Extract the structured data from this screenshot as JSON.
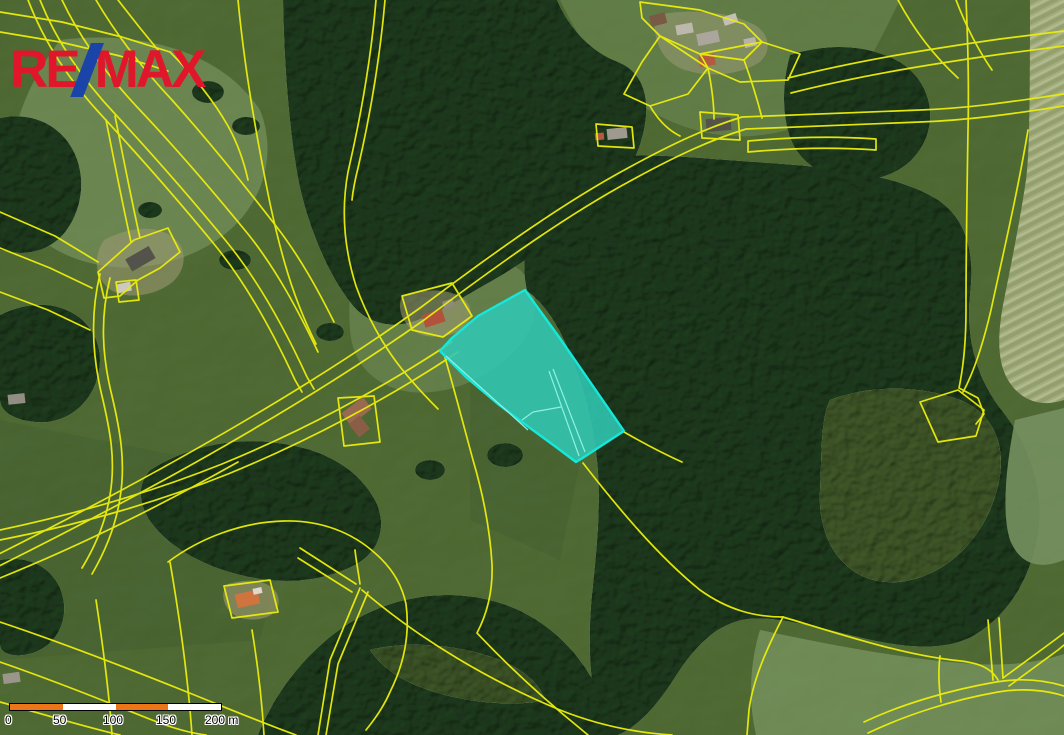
{
  "page": {
    "title": "Aerial cadastral map with highlighted parcel"
  },
  "logo": {
    "re": "RE",
    "slash_glyph": "/",
    "max": "MAX",
    "color_red": "#e0162b",
    "color_blue": "#1b44a8"
  },
  "map": {
    "boundary_color": "#eaed0c",
    "highlight": {
      "fill": "#30c7b3",
      "stroke": "#14e8da",
      "points": "525,290 559,337 624,431 581,459 576,462 556,447 530,428 498,404 466,377 440,351 452,338 478,316"
    },
    "terrain_colors": {
      "meadow": "#76905f",
      "forest": "#3a5743",
      "mowed_field": "#a8b183"
    }
  },
  "scalebar": {
    "ticks": [
      "0",
      "50",
      "100",
      "150"
    ],
    "end_label": "200 m",
    "segment_colors": [
      "#ec7419",
      "#ffffff",
      "#ec7419",
      "#ffffff"
    ]
  }
}
